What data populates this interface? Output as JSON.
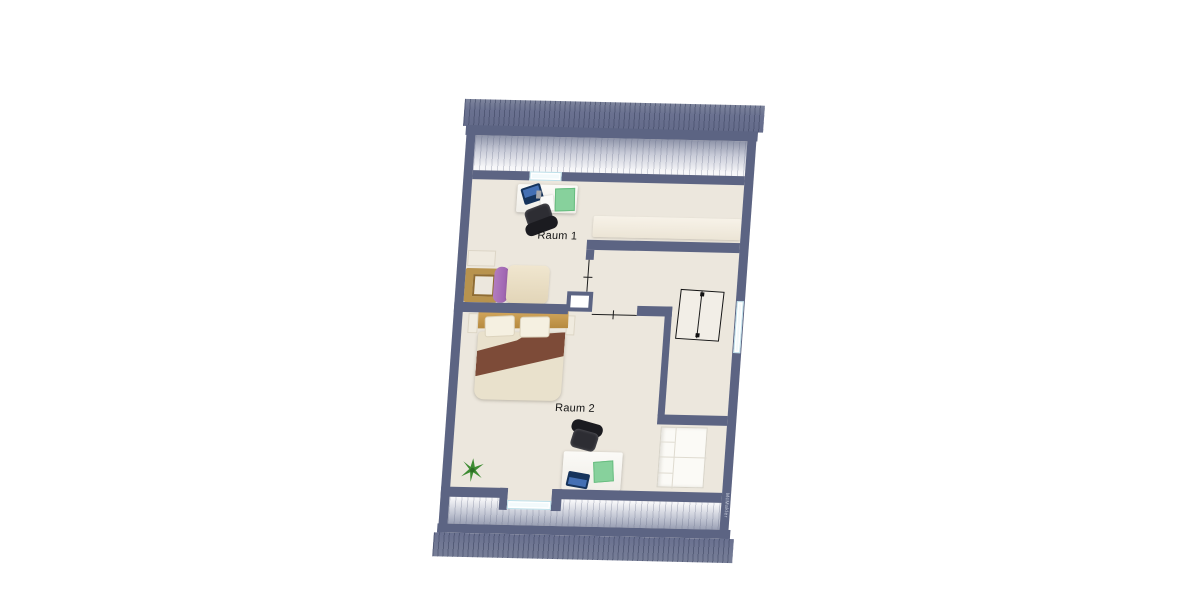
{
  "document": {
    "type": "floor-plan",
    "floor": "attic-storey"
  },
  "rooms": [
    {
      "id": "raum-1",
      "label": "Raum 1",
      "furniture": [
        "desk",
        "laptop",
        "desk-mat",
        "office-chair",
        "single-bed",
        "low-cabinet"
      ]
    },
    {
      "id": "raum-2",
      "label": "Raum 2",
      "furniture": [
        "double-bed",
        "desk",
        "laptop",
        "desk-mat",
        "office-chair",
        "potted-plant",
        "open-shelf"
      ]
    }
  ],
  "hallway": {
    "features": [
      "staircase",
      "chimney-shaft",
      "door-opening",
      "passage-opening",
      "window"
    ]
  },
  "openings": {
    "windows": 3,
    "roof_hatch_bands": 2
  },
  "watermark": {
    "label": "McMakler"
  },
  "colors": {
    "wall": "#5c6483",
    "floor": "#ece7dd",
    "roof_hatch": "#6a7190",
    "glazing": "#f2fafc",
    "cabinet_cream": "#f3eee4",
    "laptop_blue": "#16345c",
    "laptop_screen": "#4470b4",
    "desk_mat_green": "#87d19c",
    "chair_black": "#2d2d33",
    "bed_wood": "#c49a52",
    "blanket_brown": "#7d4b38",
    "pillow_purple": "#a76db6",
    "plant_green": "#3e8c32"
  }
}
